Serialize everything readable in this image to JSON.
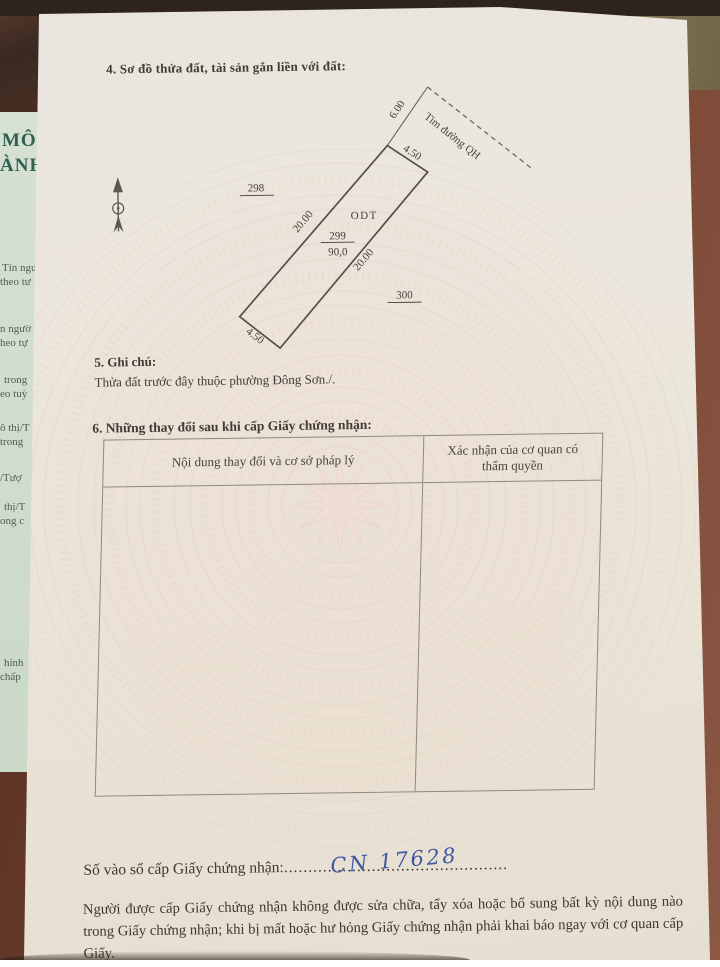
{
  "colors": {
    "handwriting_ink": "#3f57a6",
    "print_ink": "#413c35",
    "paper": "#ebe5db",
    "guilloche_pink": "#eccfc5",
    "underpage_green": "#d2decf",
    "wood_brown": "#6e4130"
  },
  "section4": {
    "title": "4. Sơ đồ thửa đất, tài sản gắn liền với đất:"
  },
  "diagram": {
    "road_centerline_label": "Tim đường QH",
    "distance_to_road": "6.00",
    "edge_top": "4.50",
    "edge_bottom": "4.50",
    "edge_left": "20.00",
    "edge_right": "20.00",
    "land_use_code": "ODT",
    "plot_number": "299",
    "plot_area": "90,0",
    "adjacent_plot_upper": "298",
    "adjacent_plot_lower": "300"
  },
  "section5": {
    "title": "5. Ghi chú:",
    "note": "Thửa đất trước đây thuộc phường Đông Sơn./."
  },
  "section6": {
    "title": "6. Những thay đổi sau khi cấp Giấy chứng nhận:",
    "table": {
      "col1_header": "Nội dung thay đổi và cơ sở pháp lý",
      "col2_header": "Xác nhận của cơ quan có thẩm quyền"
    }
  },
  "registry": {
    "label": "Số vào sổ cấp Giấy chứng nhận:",
    "dots": "..............................................",
    "handwritten_number": "CN 17628"
  },
  "footer_note": "Người được cấp Giấy chứng nhận không được sửa chữa, tẩy xóa hoặc bổ sung bất kỳ nội dung nào trong Giấy chứng nhận; khi bị mất hoặc hư hỏng Giấy chứng nhận phải khai báo ngay với cơ quan cấp Giấy.",
  "underlying_page": {
    "fragments": [
      "MÔI",
      "ÀNH)",
      "Tín ngư",
      "theo tư",
      "n ngườ",
      "heo tự",
      "trong",
      "eo tuỳ",
      "ô thị/T",
      "trong",
      "/Tượ",
      "thị/T",
      "ong c",
      "hính",
      "chấp"
    ]
  }
}
